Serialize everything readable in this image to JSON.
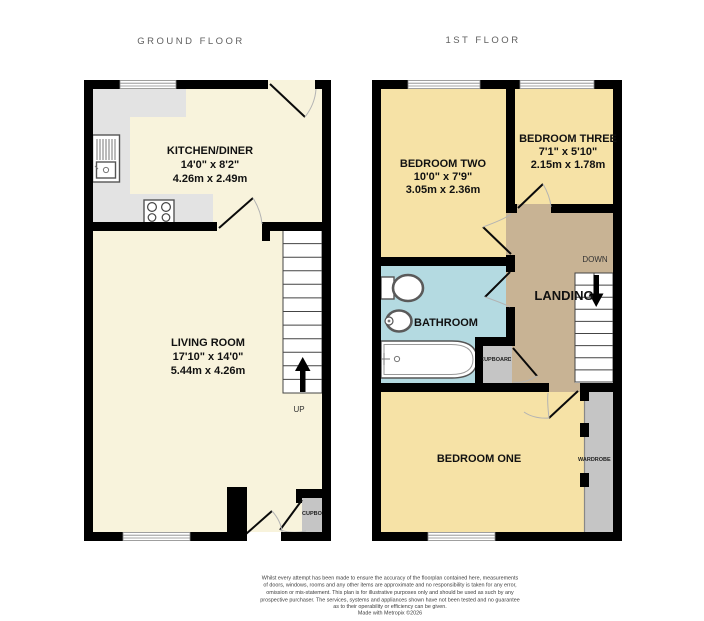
{
  "ground_floor": {
    "title": "GROUND FLOOR",
    "kitchen": {
      "name": "KITCHEN/DINER",
      "imperial": "14'0\" x 8'2\"",
      "metric": "4.26m x 2.49m"
    },
    "living": {
      "name": "LIVING ROOM",
      "imperial": "17'10\" x 14'0\"",
      "metric": "5.44m x 4.26m"
    },
    "up": "UP",
    "cupboard": "CUPBOARD"
  },
  "first_floor": {
    "title": "1ST FLOOR",
    "bedroom_two": {
      "name": "BEDROOM TWO",
      "imperial": "10'0\" x 7'9\"",
      "metric": "3.05m x 2.36m"
    },
    "bedroom_three": {
      "name": "BEDROOM THREE",
      "imperial": "7'1\" x 5'10\"",
      "metric": "2.15m x 1.78m"
    },
    "bathroom": {
      "name": "BATHROOM"
    },
    "bedroom_one": {
      "name": "BEDROOM ONE"
    },
    "landing": "LANDING",
    "down": "DOWN",
    "cupboard": "CUPBOARD",
    "wardrobe": "WARDROBE"
  },
  "footer": {
    "disclaimer_lines": [
      "Whilst every attempt has been made to ensure the accuracy of the floorplan contained here, measurements",
      "of doors, windows, rooms and any other items are approximate and no responsibility is taken for any error,",
      "omission or mis-statement. This plan is for illustrative purposes only and should be used as such by any",
      "prospective purchaser. The services, systems and appliances shown have not been tested and no guarantee",
      "as to their operability or efficiency can be given."
    ],
    "credit": "Made with Metropix ©2026"
  },
  "colors": {
    "wall": "#000000",
    "floor_cream": "#f8f3dc",
    "bedroom_yellow": "#f6e2a6",
    "bathroom_blue": "#b4dae1",
    "landing_tan": "#c8b394",
    "counter_gray": "#e3e3e3",
    "storage_gray": "#c5c5c5"
  }
}
